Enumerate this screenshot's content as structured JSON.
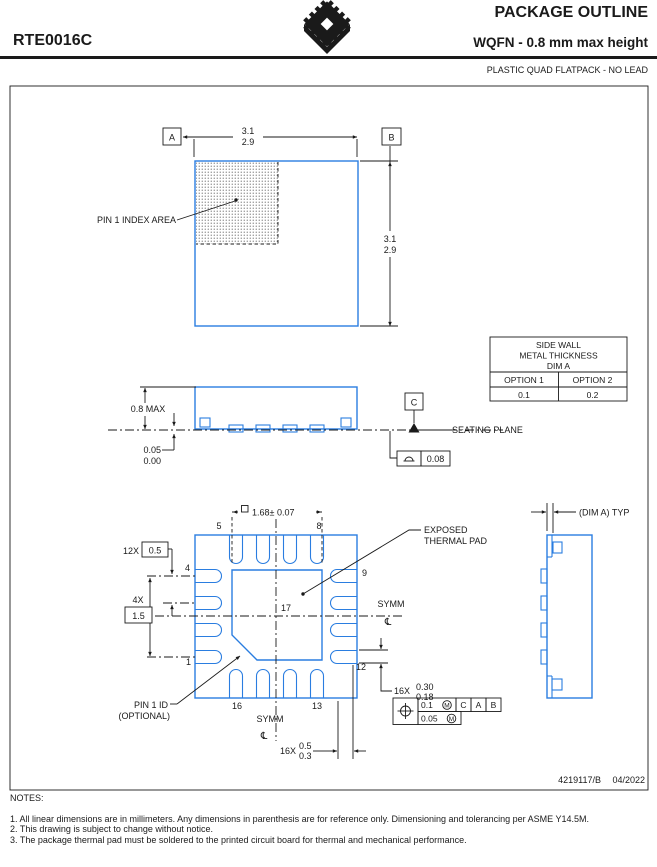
{
  "colors": {
    "accent_blue": "#2a7de0",
    "line_black": "#1a1a1a"
  },
  "header": {
    "part_number": "RTE0016C",
    "title": "PACKAGE OUTLINE",
    "subtitle": "WQFN - 0.8 mm max height",
    "package_type": "PLASTIC QUAD FLATPACK - NO LEAD"
  },
  "top_view": {
    "datum_a": "A",
    "datum_b": "B",
    "width_max": "3.1",
    "width_min": "2.9",
    "height_max": "3.1",
    "height_min": "2.9",
    "pin1_index_label": "PIN 1 INDEX AREA"
  },
  "side_view": {
    "max_height": "0.8 MAX",
    "standoff_max": "0.05",
    "standoff_min": "0.00",
    "datum_c": "C",
    "seating_plane": "SEATING PLANE",
    "flatness": "0.08"
  },
  "side_wall_table": {
    "title_line1": "SIDE WALL",
    "title_line2": "METAL THICKNESS",
    "title_line3": "DIM A",
    "option1": "OPTION 1",
    "option2": "OPTION 2",
    "option1_value": "0.1",
    "option2_value": "0.2"
  },
  "bottom_view": {
    "thermal_pad_dim": "1.68± 0.07",
    "pitch_count": "12X",
    "pitch_value": "0.5",
    "span_count": "4X",
    "span_value": "1.5",
    "lead_width_count": "16X",
    "lead_width_max": "0.30",
    "lead_width_min": "0.18",
    "lead_length_count": "16X",
    "lead_length_max": "0.5",
    "lead_length_min": "0.3",
    "exposed_pad_line1": "EXPOSED",
    "exposed_pad_line2": "THERMAL PAD",
    "symm_label": "SYMM",
    "centerline_glyph": "℄",
    "pin1_id_line1": "PIN 1 ID",
    "pin1_id_line2": "(OPTIONAL)",
    "pins": {
      "pin1": "1",
      "pin4": "4",
      "pin5": "5",
      "pin8": "8",
      "pin9": "9",
      "pin12": "12",
      "pin13": "13",
      "pin16": "16",
      "pin17": "17"
    },
    "position_tolerance": "0.1",
    "position_modifier": "M",
    "position_datums": [
      "C",
      "A",
      "B"
    ],
    "coplanarity_tolerance": "0.05",
    "coplanarity_modifier": "M"
  },
  "detail_view": {
    "dim_label": "(DIM A) TYP"
  },
  "footer": {
    "drawing_number": "4219117/B",
    "revision_date": "04/2022"
  },
  "notes": {
    "title": "NOTES:",
    "items": [
      "1. All linear dimensions are in millimeters. Any dimensions in parenthesis are for reference only. Dimensioning and tolerancing per ASME Y14.5M.",
      "2. This drawing is subject to change without notice.",
      "3. The package thermal pad must be soldered to the printed circuit board for thermal and mechanical performance."
    ]
  }
}
